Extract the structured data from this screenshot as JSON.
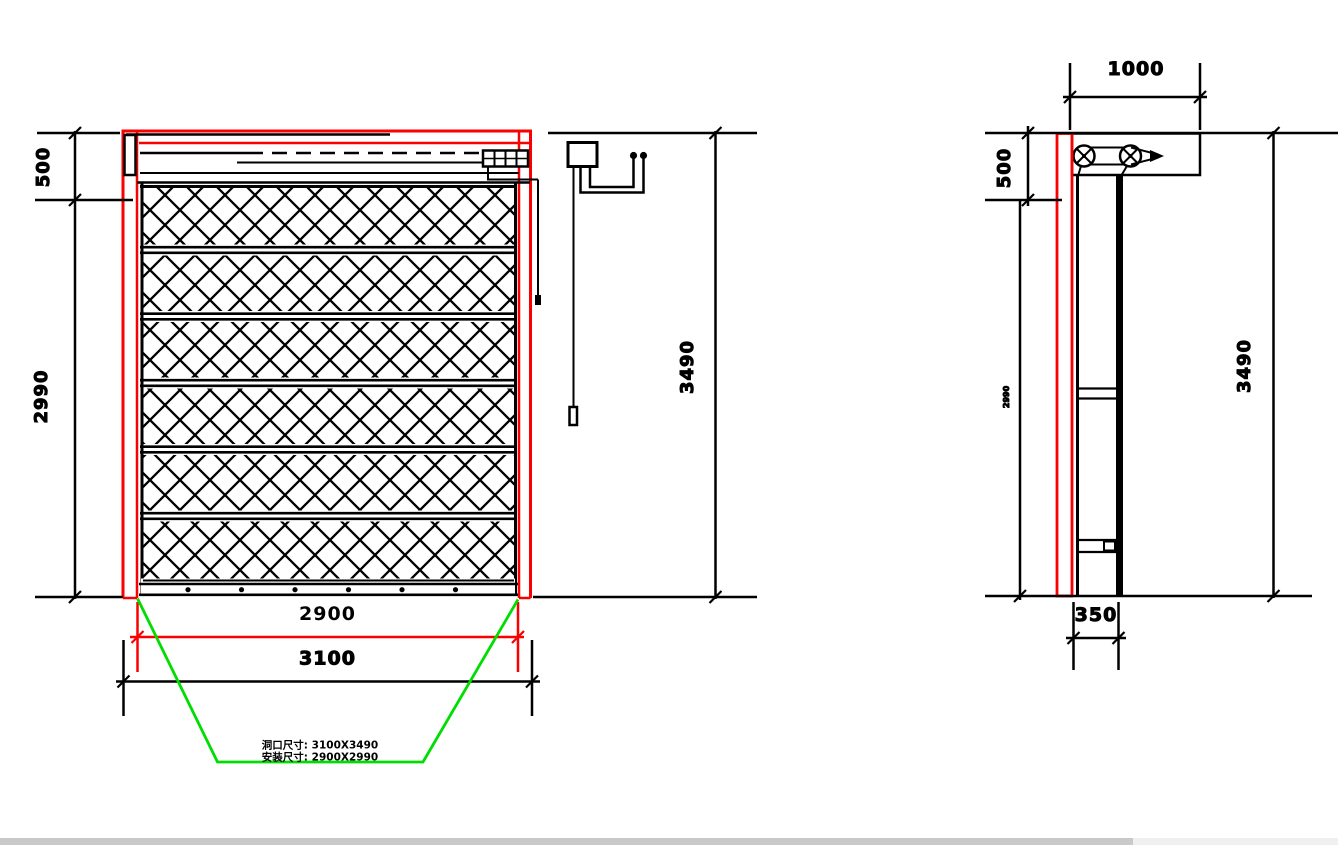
{
  "front_view": {
    "dim_header_height": "500",
    "dim_body_height": "2990",
    "dim_shutter_width": "2900",
    "dim_opening_width": "3100",
    "dim_overall_height": "3490",
    "note_line1": "洞口尺寸: 3100X3490",
    "note_line2": "安装尺寸: 2900X2990"
  },
  "side_view": {
    "dim_box_width": "1000",
    "dim_header_height": "500",
    "dim_body_height": "2990",
    "dim_overall_height": "3490",
    "dim_base_depth": "350"
  },
  "colors": {
    "line": "#000000",
    "highlight_red": "#fa0000",
    "annotation_green": "#00dd00",
    "scrollbar_thumb": "#c9c9c9",
    "scrollbar_track": "#f0f0f0",
    "background": "#ffffff"
  }
}
